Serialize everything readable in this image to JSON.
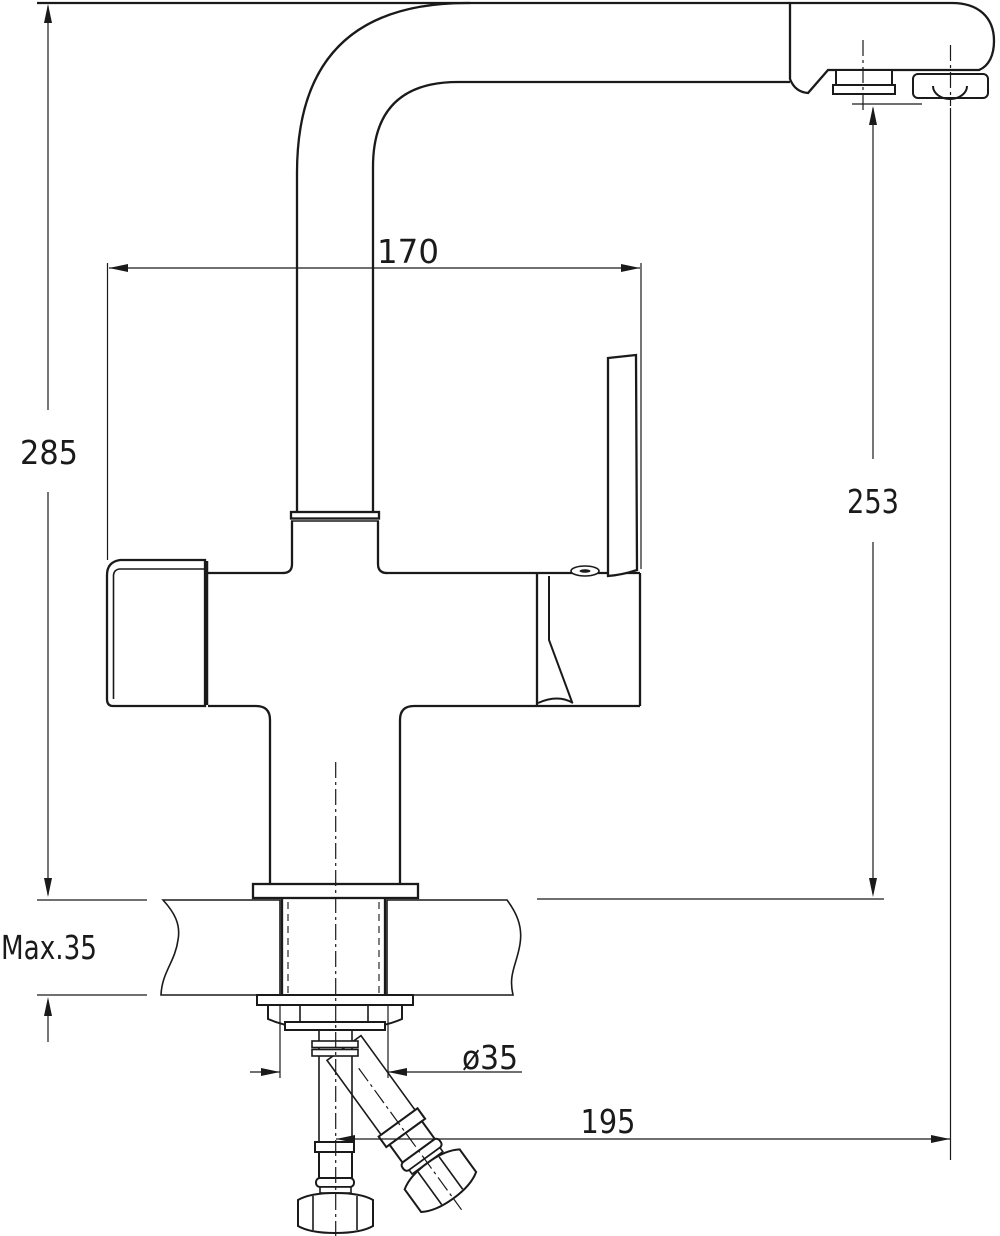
{
  "drawing": {
    "background_color": "#ffffff",
    "line_color": "#1a1a1a",
    "type": "faucet-installation-dimension-drawing",
    "dimensions": {
      "top_width": {
        "label": "170"
      },
      "overall_height": {
        "label": "285"
      },
      "spout_height": {
        "label": "253"
      },
      "deck_max_thickness": {
        "label": "Max.35"
      },
      "mounting_hole_diameter": {
        "label": "ø35"
      },
      "spout_reach": {
        "label": "195"
      }
    }
  }
}
